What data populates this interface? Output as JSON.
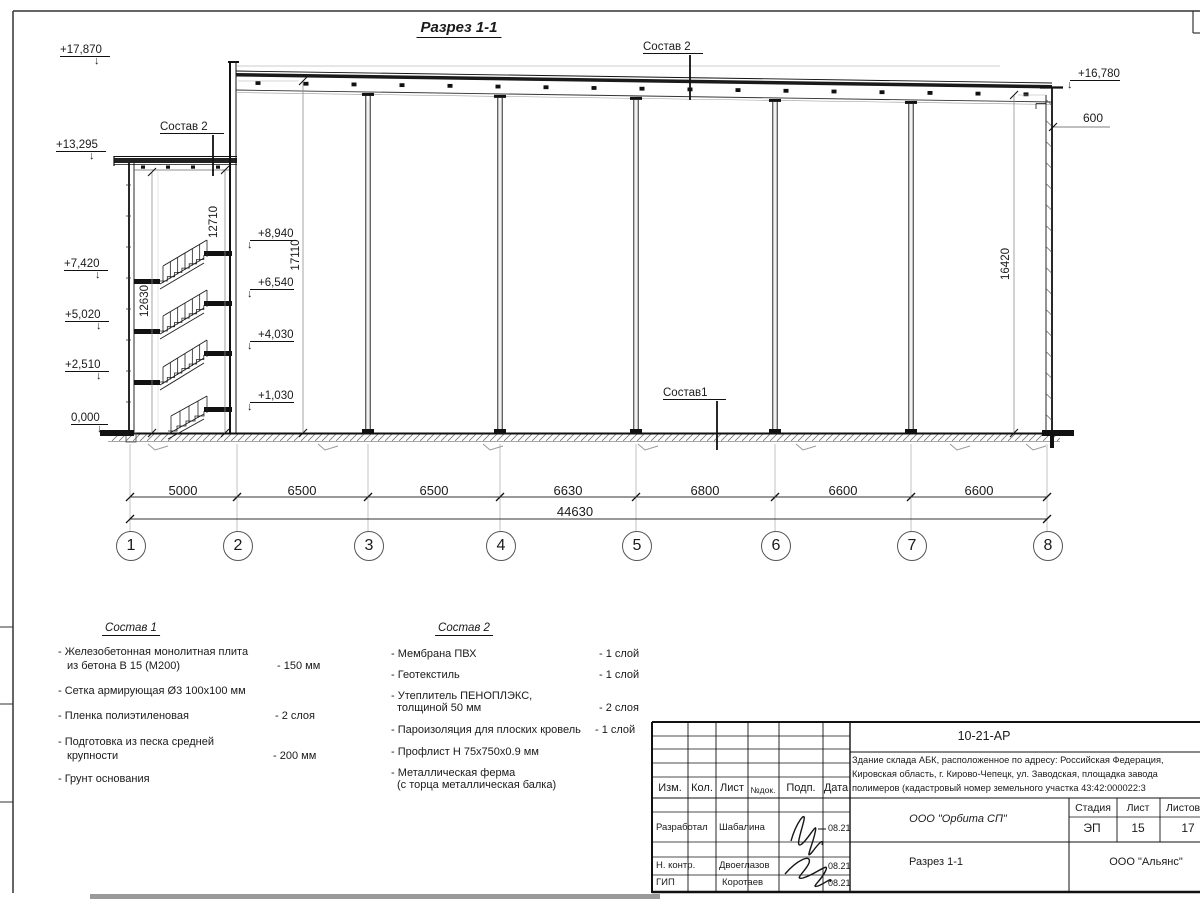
{
  "icons": {
    "elevation_arrow": "↓"
  },
  "sheet": {
    "title": "Разрез 1-1"
  },
  "marks": {
    "left": [
      "+17,870",
      "+13,295",
      "+7,420",
      "+5,020",
      "+2,510",
      "0,000"
    ],
    "inner": [
      "+8,940",
      "+6,540",
      "+4,030",
      "+1,030"
    ],
    "right_top": "+16,780",
    "right_600": "600",
    "vdims": [
      "12630",
      "12710",
      "17110",
      "16420"
    ],
    "sostav2_left": "Состав 2",
    "sostav2_right": "Состав 2",
    "sostav1": "Состав1"
  },
  "dims": {
    "spans": [
      "5000",
      "6500",
      "6500",
      "6630",
      "6800",
      "6600",
      "6600"
    ],
    "total": "44630"
  },
  "grid": [
    "1",
    "2",
    "3",
    "4",
    "5",
    "6",
    "7",
    "8"
  ],
  "legend1": {
    "heading": "Состав 1",
    "i1a": "- Железобетонная  монолитная плита",
    "i1b": "из бетона В 15 (М200)",
    "i1v": "- 150 мм",
    "i2a": "- Сетка армирующая Ø3 100х100 мм",
    "i3a": "- Пленка полиэтиленовая",
    "i3v": "-  2 слоя",
    "i4a": "- Подготовка из песка средней",
    "i4b": "крупности",
    "i4v": "- 200 мм",
    "i5a": "- Грунт основания"
  },
  "legend2": {
    "heading": "Состав 2",
    "i1a": "- Мембрана ПВХ",
    "i1v": "- 1 слой",
    "i2a": "- Геотекстиль",
    "i2v": "- 1 слой",
    "i3a": "- Утеплитель ПЕНОПЛЭКС,",
    "i3b": "толщиной 50 мм",
    "i3v": "- 2 слоя",
    "i4a": "- Пароизоляция для плоских кровель",
    "i4v": "- 1 слой",
    "i5a": "- Профлист Н 75х750х0.9 мм",
    "i6a": "- Металлическая ферма",
    "i6b": "(с торца металлическая балка)"
  },
  "titleblock": {
    "doc": "10-21-АР",
    "desc1": "Здание склада АБК, расположенное по адресу: Российская Федерация,",
    "desc2": "Кировская область, г. Кирово-Чепецк, ул. Заводская, площадка завода",
    "desc3": "полимеров (кадастровый номер земельного участка 43:42:000022:3",
    "h_izm": "Изм.",
    "h_kol": "Кол.",
    "h_list": "Лист",
    "h_ndok": "№док.",
    "h_podp": "Подп.",
    "h_data": "Дата",
    "r1l": "Разработал",
    "r1n": "Шабалина",
    "r1d": "08.21",
    "r2l": "Н. контр.",
    "r2n": "Двоеглазов",
    "r2d": "08.21",
    "r3l": "ГИП",
    "r3n": "Коротаев",
    "r3d": "08.21",
    "org1": "ООО \"Орбита СП\"",
    "stage_h": "Стадия",
    "list_h": "Лист",
    "listov_h": "Листов",
    "stage_v": "ЭП",
    "list_v": "15",
    "listov_v": "17",
    "dwg": "Разрез 1-1",
    "org2": "ООО \"Альянс\""
  }
}
